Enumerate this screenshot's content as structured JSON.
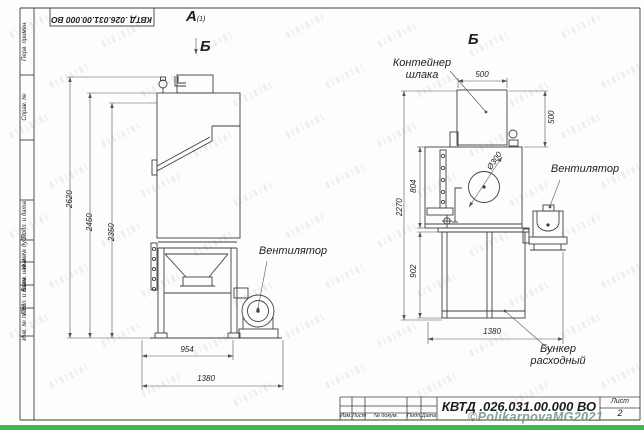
{
  "sheet": {
    "designation": "КВТД .026.031.00.000 ВО",
    "sheet_label": "Лист",
    "sheet_number": "2",
    "watermark": "©PolikarpovaMG2021",
    "title_block_columns": [
      "Изм.",
      "Лист",
      "№ докум.",
      "Подп.",
      "Дата"
    ],
    "stamp_fields": [
      "Перв. примен.",
      "Справ. №",
      "Подп. и дата",
      "Инв. № дубл.",
      "Взам. инв. №",
      "Подп. и дата",
      "Инв. № подл."
    ]
  },
  "views": {
    "a_label": "А",
    "a_sub": "(1)",
    "b_marker": "Б",
    "b_title": "Б"
  },
  "labels": {
    "fan_left": "Вентилятор",
    "fan_right": "Вентилятор",
    "slag_container_1": "Контейнер",
    "slag_container_2": "шлака",
    "hopper_1": "Бункер",
    "hopper_2": "расходный"
  },
  "dimensions": {
    "left_view": {
      "height_total": "2620",
      "height_cabinet": "2450",
      "height_inner": "2350",
      "width_frame": "954",
      "width_total": "1380"
    },
    "right_view": {
      "container_width": "500",
      "container_height": "500",
      "port_diameter": "Ø300",
      "body_height": "804",
      "height_total": "2270",
      "hopper_height": "902",
      "width_total": "1380"
    }
  },
  "colors": {
    "line": "#3f3f3f",
    "dim_line": "#555555",
    "green_bar": "#3fb94d",
    "watermark": "#7fa184"
  }
}
